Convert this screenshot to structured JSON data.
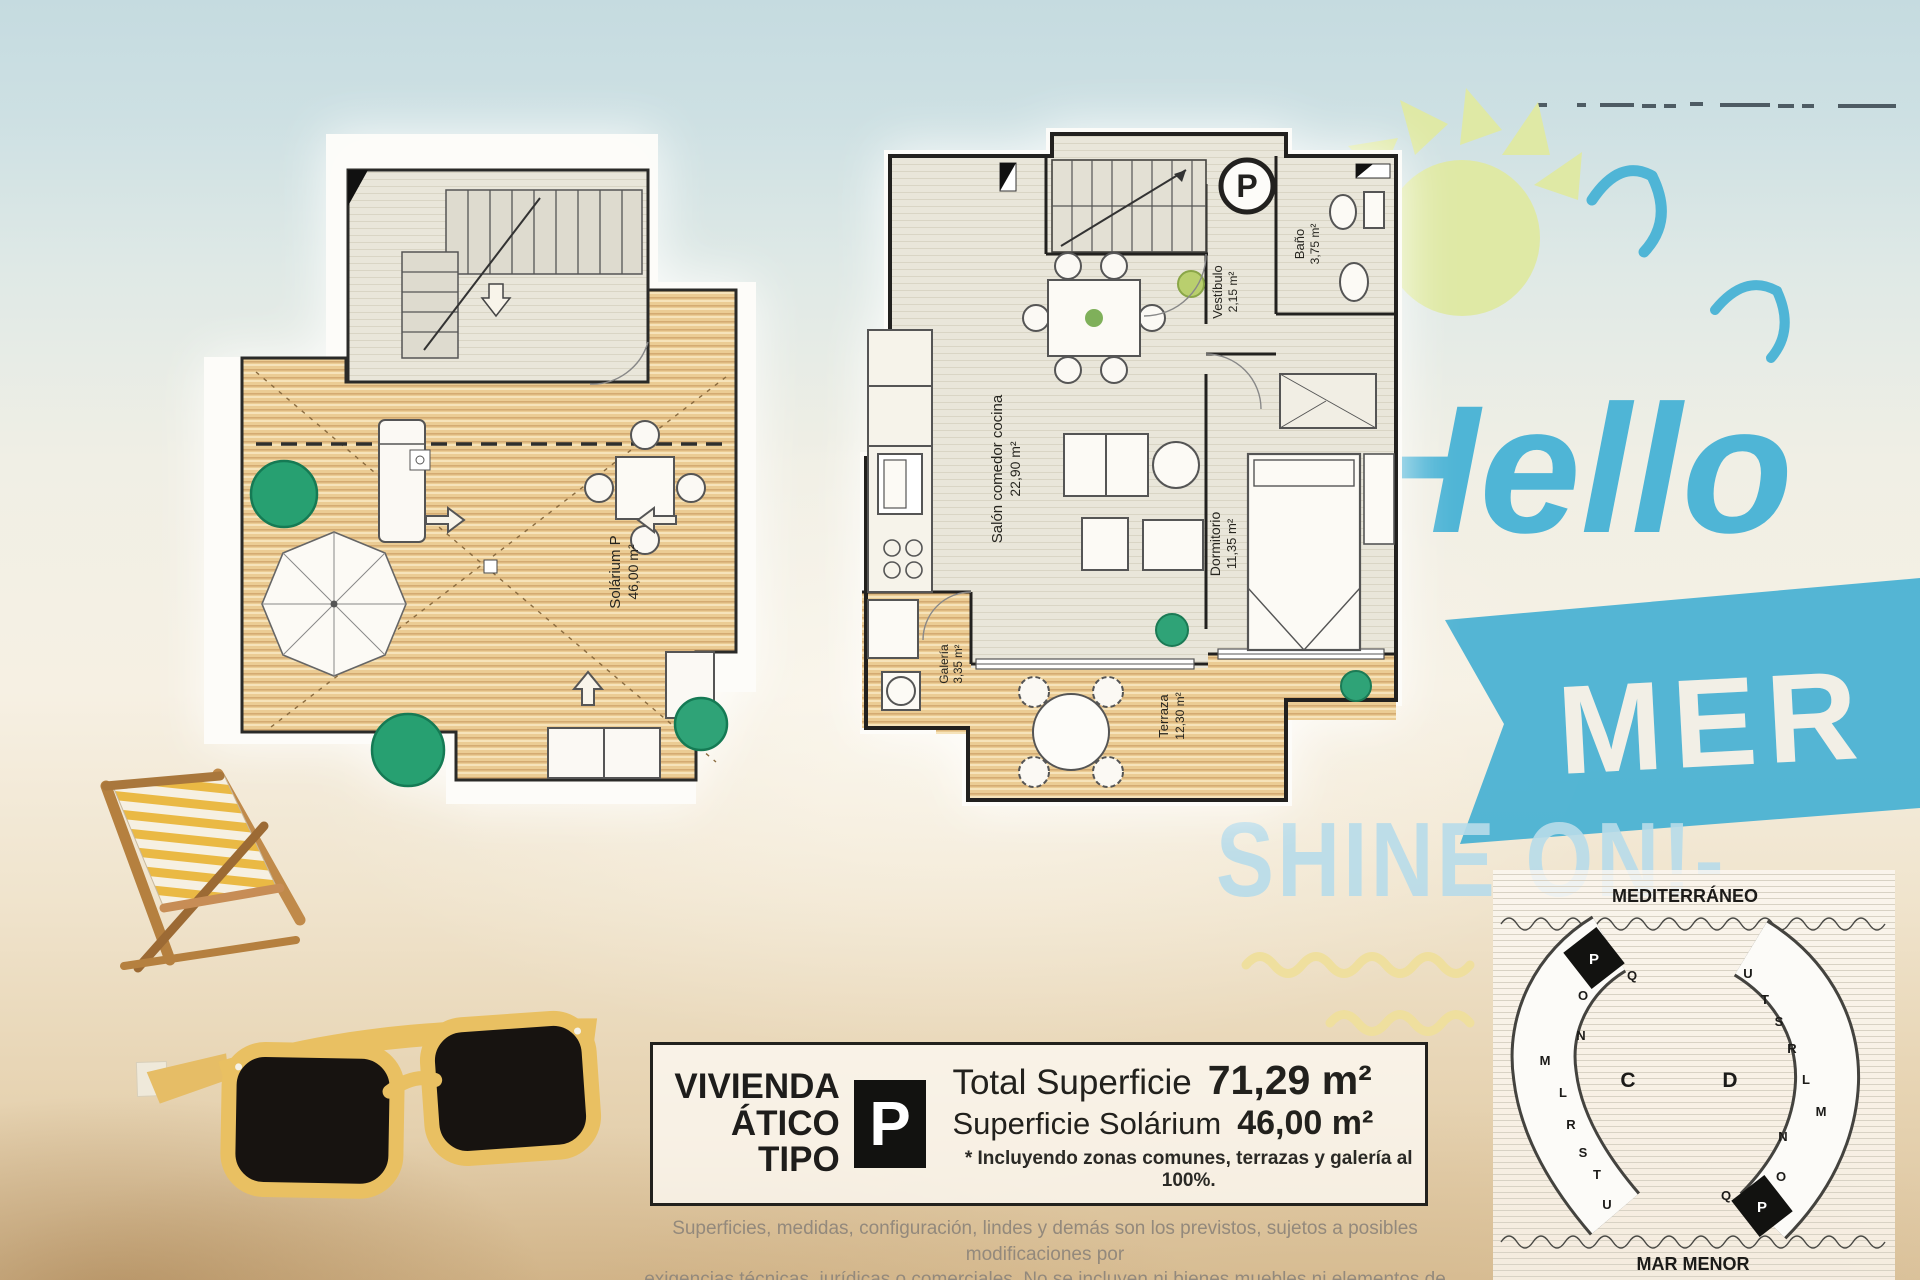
{
  "branding": {
    "hello_script": "Hello",
    "banner_word": "MER",
    "shine_line": "SHINE ON!-",
    "script_blue": "#4fb5d6",
    "banner_blue": "#45b0d3",
    "shine_blue": "#b8dcea"
  },
  "plan_upper": {
    "label": "Solárium P",
    "area": "46,00 m²"
  },
  "plan_main": {
    "unit_badge": "P",
    "rooms": {
      "salon": {
        "name": "Salón comedor cocina",
        "area": "22,90 m²"
      },
      "vestibulo": {
        "name": "Vestíbulo",
        "area": "2,15 m²"
      },
      "bano": {
        "name": "Baño",
        "area": "3,75 m²"
      },
      "dormitorio": {
        "name": "Dormitorio",
        "area": "11,35 m²"
      },
      "galeria": {
        "name": "Galería",
        "area": "3,35 m²"
      },
      "terraza": {
        "name": "Terraza",
        "area": "12,30 m²"
      }
    }
  },
  "info_box": {
    "title_line1": "VIVIENDA",
    "title_line2": "ÁTICO TIPO",
    "type_letter": "P",
    "total_label": "Total Superficie",
    "total_value": "71,29 m²",
    "solarium_label": "Superficie Solárium",
    "solarium_value": "46,00 m²",
    "note": "* Incluyendo zonas comunes, terrazas y galería al 100%."
  },
  "disclaimer": {
    "line1": "Superficies, medidas, configuración, lindes y demás son los previstos, sujetos a posibles modificaciones por",
    "line2": "exigencias técnicas, jurídicas o comerciales. No se incluyen ni bienes muebles ni elementos de jardinería."
  },
  "site_plan": {
    "sea_label": "MEDITERRÁNEO",
    "lagoon_label": "MAR MENOR",
    "building_c": {
      "label": "C",
      "highlighted": "P",
      "units": [
        "P",
        "Q",
        "O",
        "N",
        "M",
        "L",
        "R",
        "S",
        "T",
        "U"
      ]
    },
    "building_d": {
      "label": "D",
      "highlighted": "P",
      "units": [
        "U",
        "T",
        "S",
        "R",
        "L",
        "M",
        "N",
        "O",
        "Q",
        "P"
      ]
    }
  }
}
